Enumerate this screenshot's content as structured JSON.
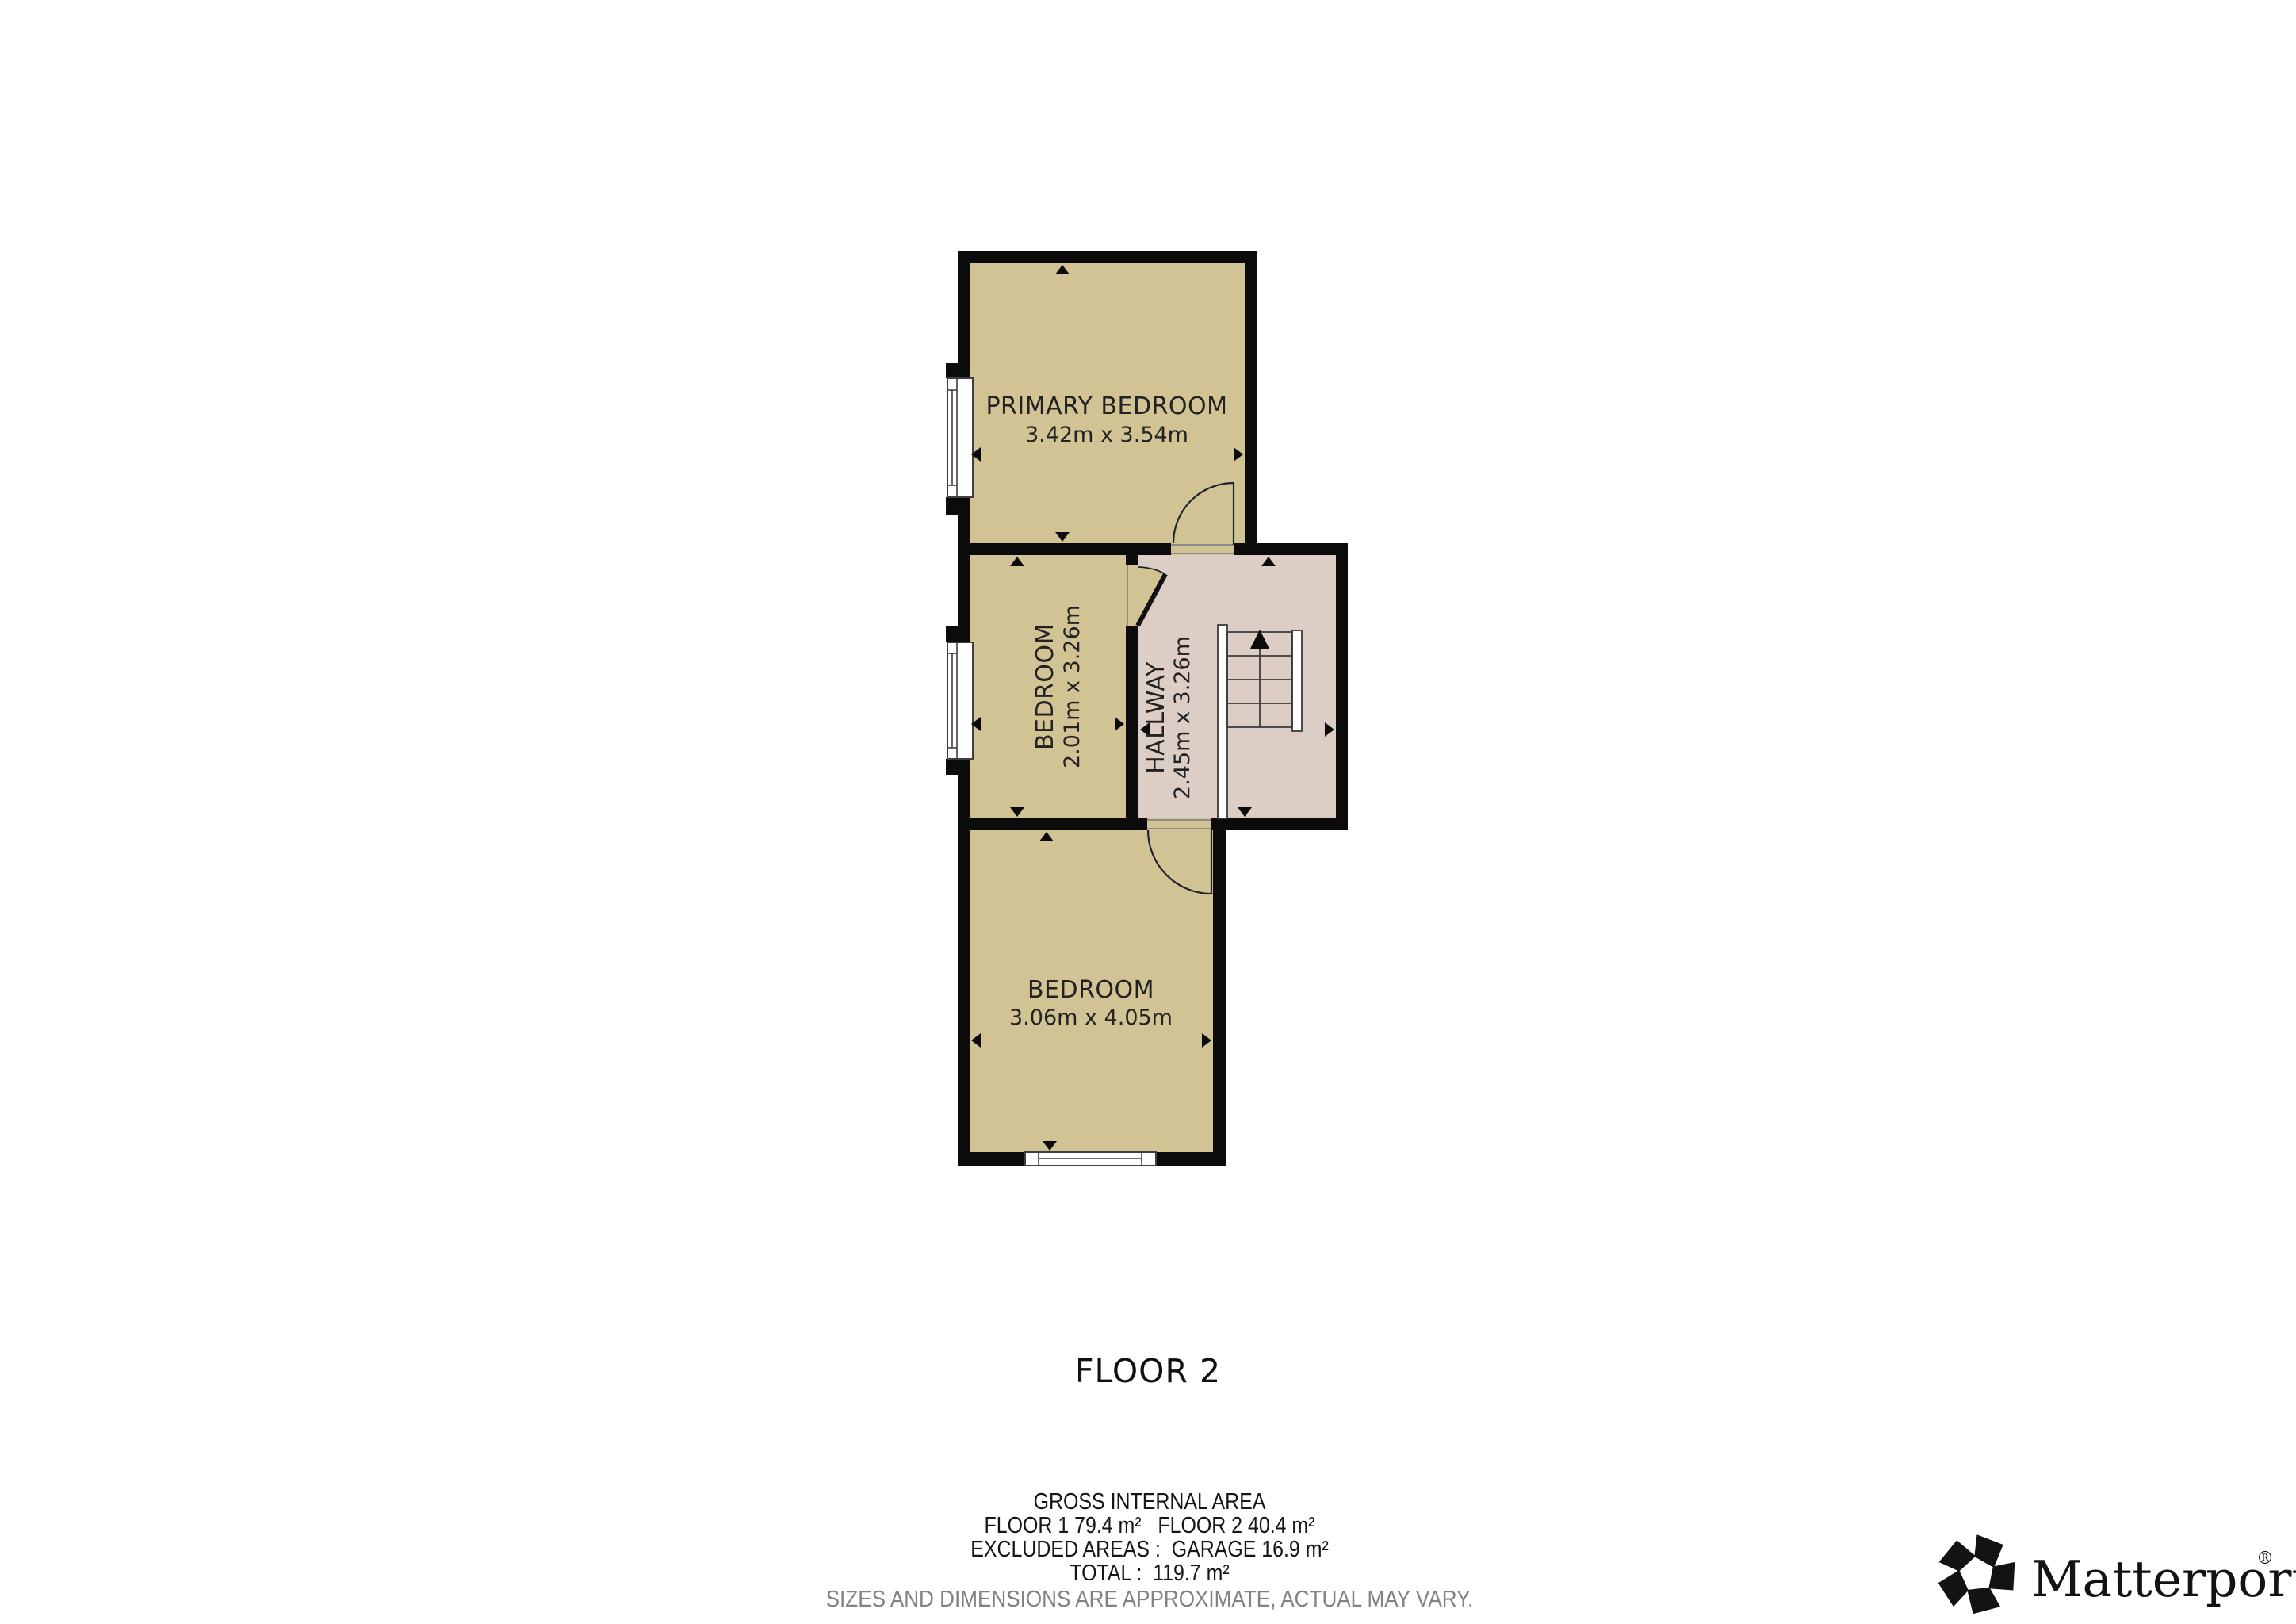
{
  "floor_plan": {
    "floor_title": "FLOOR 2",
    "rooms": [
      {
        "name": "PRIMARY BEDROOM",
        "dims": "3.42m x 3.54m"
      },
      {
        "name": "BEDROOM",
        "dims": "2.01m x 3.26m"
      },
      {
        "name": "HALLWAY",
        "dims": "2.45m x 3.26m"
      },
      {
        "name": "BEDROOM",
        "dims": "3.06m x 4.05m"
      }
    ]
  },
  "area_summary": {
    "title": "GROSS INTERNAL AREA",
    "floors_line": "FLOOR 1 79.4 m²   FLOOR 2 40.4 m²",
    "excluded_line": "EXCLUDED AREAS :  GARAGE 16.9 m²",
    "total_line": "TOTAL :  119.7 m²",
    "disclaimer": "SIZES AND DIMENSIONS ARE APPROXIMATE, ACTUAL MAY VARY."
  },
  "branding": {
    "logo_text": "Matterport",
    "registered_mark": "®"
  },
  "colors": {
    "room_fill": "#d2c394",
    "hallway_fill": "#dccdc5",
    "wall": "#0b0b0b",
    "label_text": "#222222",
    "disclaimer_text": "#828282"
  }
}
